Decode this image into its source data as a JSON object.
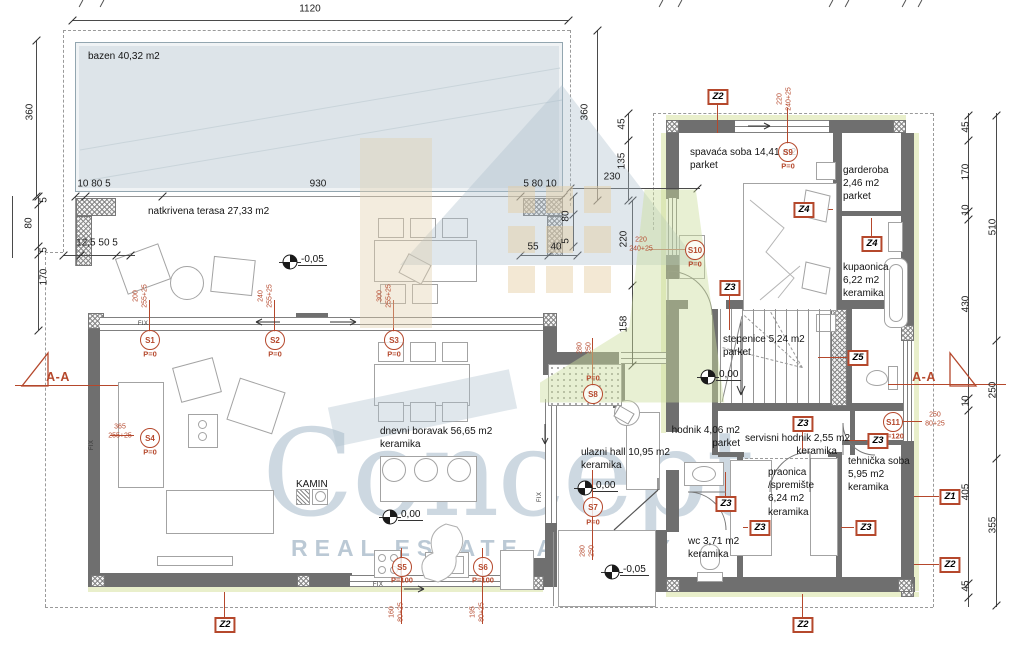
{
  "watermark": {
    "brand": "Concept",
    "subtitle": "REAL ESTATE AGENCY"
  },
  "plan": {
    "porch_number": "3.4684",
    "fix_label": "FIX",
    "section_label": "A-A",
    "rooms": [
      {
        "id": "bazen",
        "lines": [
          "bazen 40,32 m2"
        ],
        "x": 88,
        "y": 50
      },
      {
        "id": "natkrivena-terasa",
        "lines": [
          "natkrivena terasa 27,33 m2"
        ],
        "x": 148,
        "y": 205
      },
      {
        "id": "dnevni-boravak",
        "lines": [
          "dnevni boravak 56,65 m2",
          "keramika"
        ],
        "x": 380,
        "y": 425
      },
      {
        "id": "ulazni-hall",
        "lines": [
          "ulazni hall 10,95 m2",
          "keramika"
        ],
        "x": 581,
        "y": 446
      },
      {
        "id": "spavaca-soba",
        "lines": [
          "spavaća soba 14,41 m2",
          "parket"
        ],
        "x": 690,
        "y": 146
      },
      {
        "id": "garderoba",
        "lines": [
          "garderoba",
          "2,46 m2",
          "parket"
        ],
        "x": 843,
        "y": 164
      },
      {
        "id": "kupaonica",
        "lines": [
          "kupaonica",
          "6,22 m2",
          "keramika"
        ],
        "x": 843,
        "y": 261
      },
      {
        "id": "stepenice",
        "lines": [
          "stepenice 5,24 m2",
          "parket"
        ],
        "x": 723,
        "y": 333
      },
      {
        "id": "hodnik",
        "lines": [
          "hodnik 4,06 m2",
          "parket"
        ],
        "x": 662,
        "y": 424,
        "w": 78,
        "align": "right"
      },
      {
        "id": "servisni-hodnik",
        "lines": [
          "servisni hodnik 2,55 m2",
          "keramika"
        ],
        "x": 745,
        "y": 432,
        "w": 92,
        "align": "right"
      },
      {
        "id": "praonica",
        "lines": [
          "praonica",
          "/spremište",
          "6,24 m2",
          "keramika"
        ],
        "x": 768,
        "y": 466
      },
      {
        "id": "wc",
        "lines": [
          "wc 3,71 m2",
          "keramika"
        ],
        "x": 688,
        "y": 535
      },
      {
        "id": "tehnicka-soba",
        "lines": [
          "tehnička soba",
          "5,95 m2",
          "keramika"
        ],
        "x": 848,
        "y": 455
      },
      {
        "id": "kamin",
        "lines": [
          "KAMIN"
        ],
        "x": 296,
        "y": 478
      }
    ],
    "dimensions": [
      {
        "text": "1120",
        "x": 310,
        "y": 9
      },
      {
        "text": "360",
        "x": 30,
        "y": 112,
        "v": true
      },
      {
        "text": "10 80 5",
        "x": 94,
        "y": 184
      },
      {
        "text": "930",
        "x": 318,
        "y": 184
      },
      {
        "text": "5 80 10",
        "x": 540,
        "y": 184
      },
      {
        "text": "230",
        "x": 612,
        "y": 177
      },
      {
        "text": "360",
        "x": 585,
        "y": 112,
        "v": true
      },
      {
        "text": "45",
        "x": 622,
        "y": 124,
        "v": true
      },
      {
        "text": "135",
        "x": 622,
        "y": 161,
        "v": true
      },
      {
        "text": "12,5 50 5",
        "x": 97,
        "y": 243
      },
      {
        "text": "5",
        "x": 44,
        "y": 200,
        "v": true
      },
      {
        "text": "80",
        "x": 29,
        "y": 223,
        "v": true
      },
      {
        "text": "5",
        "x": 44,
        "y": 250,
        "v": true
      },
      {
        "text": "170",
        "x": 44,
        "y": 277,
        "v": true
      },
      {
        "text": "55",
        "x": 533,
        "y": 247
      },
      {
        "text": "40",
        "x": 556,
        "y": 247
      },
      {
        "text": "80",
        "x": 566,
        "y": 216,
        "v": true
      },
      {
        "text": "5",
        "x": 566,
        "y": 241,
        "v": true
      },
      {
        "text": "220",
        "x": 624,
        "y": 239,
        "v": true
      },
      {
        "text": "158",
        "x": 624,
        "y": 324,
        "v": true
      },
      {
        "text": "45",
        "x": 966,
        "y": 127,
        "v": true
      },
      {
        "text": "170",
        "x": 966,
        "y": 172,
        "v": true
      },
      {
        "text": "10",
        "x": 966,
        "y": 210,
        "v": true
      },
      {
        "text": "430",
        "x": 966,
        "y": 304,
        "v": true
      },
      {
        "text": "10",
        "x": 966,
        "y": 401,
        "v": true
      },
      {
        "text": "405",
        "x": 966,
        "y": 492,
        "v": true
      },
      {
        "text": "45",
        "x": 966,
        "y": 586,
        "v": true
      },
      {
        "text": "510",
        "x": 993,
        "y": 227,
        "v": true
      },
      {
        "text": "250",
        "x": 993,
        "y": 390,
        "v": true
      },
      {
        "text": "355",
        "x": 993,
        "y": 525,
        "v": true
      }
    ],
    "openings": [
      {
        "id": "S1",
        "p": "P=0",
        "size": "200\n255+25",
        "cx": 150,
        "cy": 340,
        "px": 150,
        "py": 354,
        "dx": 141,
        "dy": 296,
        "dv": true
      },
      {
        "id": "S2",
        "p": "P=0",
        "size": "240\n255+25",
        "cx": 275,
        "cy": 340,
        "px": 275,
        "py": 354,
        "dx": 266,
        "dy": 296,
        "dv": true
      },
      {
        "id": "S3",
        "p": "P=0",
        "size": "300\n255+25",
        "cx": 394,
        "cy": 340,
        "px": 394,
        "py": 354,
        "dx": 385,
        "dy": 296,
        "dv": true
      },
      {
        "id": "S4",
        "p": "P=0",
        "size": "365\n255+25",
        "cx": 150,
        "cy": 438,
        "px": 150,
        "py": 452,
        "dx": 120,
        "dy": 432,
        "dv": false
      },
      {
        "id": "S5",
        "p": "P=100",
        "size": "160\n80+25",
        "cx": 402,
        "cy": 567,
        "px": 402,
        "py": 580,
        "dx": 397,
        "dy": 612,
        "dv": true
      },
      {
        "id": "S6",
        "p": "P=100",
        "size": "195\n80+25",
        "cx": 483,
        "cy": 567,
        "px": 483,
        "py": 580,
        "dx": 478,
        "dy": 612,
        "dv": true
      },
      {
        "id": "S7",
        "p": "P=0",
        "size": "280\n250",
        "cx": 593,
        "cy": 507,
        "px": 593,
        "py": 522,
        "dx": 588,
        "dy": 551,
        "dv": true
      },
      {
        "id": "S8",
        "p": "P=0",
        "size": "280\n250",
        "cx": 593,
        "cy": 394,
        "px": 593,
        "py": 378,
        "dx": 585,
        "dy": 348,
        "dv": true
      },
      {
        "id": "S9",
        "p": "P=0",
        "size": "220\n240+25",
        "cx": 788,
        "cy": 152,
        "px": 788,
        "py": 166,
        "dx": 785,
        "dy": 99,
        "dv": true
      },
      {
        "id": "S10",
        "p": "P=0",
        "size": "220\n240+25",
        "cx": 695,
        "cy": 250,
        "px": 695,
        "py": 264,
        "dx": 641,
        "dy": 245,
        "dv": false
      },
      {
        "id": "S11",
        "p": "P=120",
        "size": "250\n80+25",
        "cx": 893,
        "cy": 422,
        "px": 893,
        "py": 436,
        "dx": 935,
        "dy": 420,
        "dv": false
      }
    ],
    "zones": [
      {
        "label": "Z2",
        "x": 718,
        "y": 97
      },
      {
        "label": "Z2",
        "x": 225,
        "y": 625
      },
      {
        "label": "Z2",
        "x": 803,
        "y": 625
      },
      {
        "label": "Z2",
        "x": 950,
        "y": 565
      },
      {
        "label": "Z1",
        "x": 950,
        "y": 497
      },
      {
        "label": "Z3",
        "x": 730,
        "y": 288
      },
      {
        "label": "Z3",
        "x": 878,
        "y": 441
      },
      {
        "label": "Z3",
        "x": 803,
        "y": 424
      },
      {
        "label": "Z3",
        "x": 726,
        "y": 504
      },
      {
        "label": "Z3",
        "x": 760,
        "y": 528
      },
      {
        "label": "Z3",
        "x": 866,
        "y": 528
      },
      {
        "label": "Z4",
        "x": 804,
        "y": 210
      },
      {
        "label": "Z4",
        "x": 872,
        "y": 244
      },
      {
        "label": "Z5",
        "x": 858,
        "y": 358
      }
    ],
    "levels": [
      {
        "value": "-0,05",
        "x": 290,
        "y": 262
      },
      {
        "value": "0,00",
        "x": 390,
        "y": 517
      },
      {
        "value": "0,00",
        "x": 585,
        "y": 488
      },
      {
        "value": "0,00",
        "x": 708,
        "y": 377
      },
      {
        "value": "-0,05",
        "x": 612,
        "y": 572
      }
    ],
    "sections": [
      {
        "x": 58,
        "y": 377
      },
      {
        "x": 924,
        "y": 377
      }
    ],
    "fix_positions": [
      {
        "x": 143,
        "y": 324
      },
      {
        "x": 378,
        "y": 585
      },
      {
        "x": 92,
        "y": 445,
        "v": true
      },
      {
        "x": 540,
        "y": 497,
        "v": true
      }
    ]
  }
}
